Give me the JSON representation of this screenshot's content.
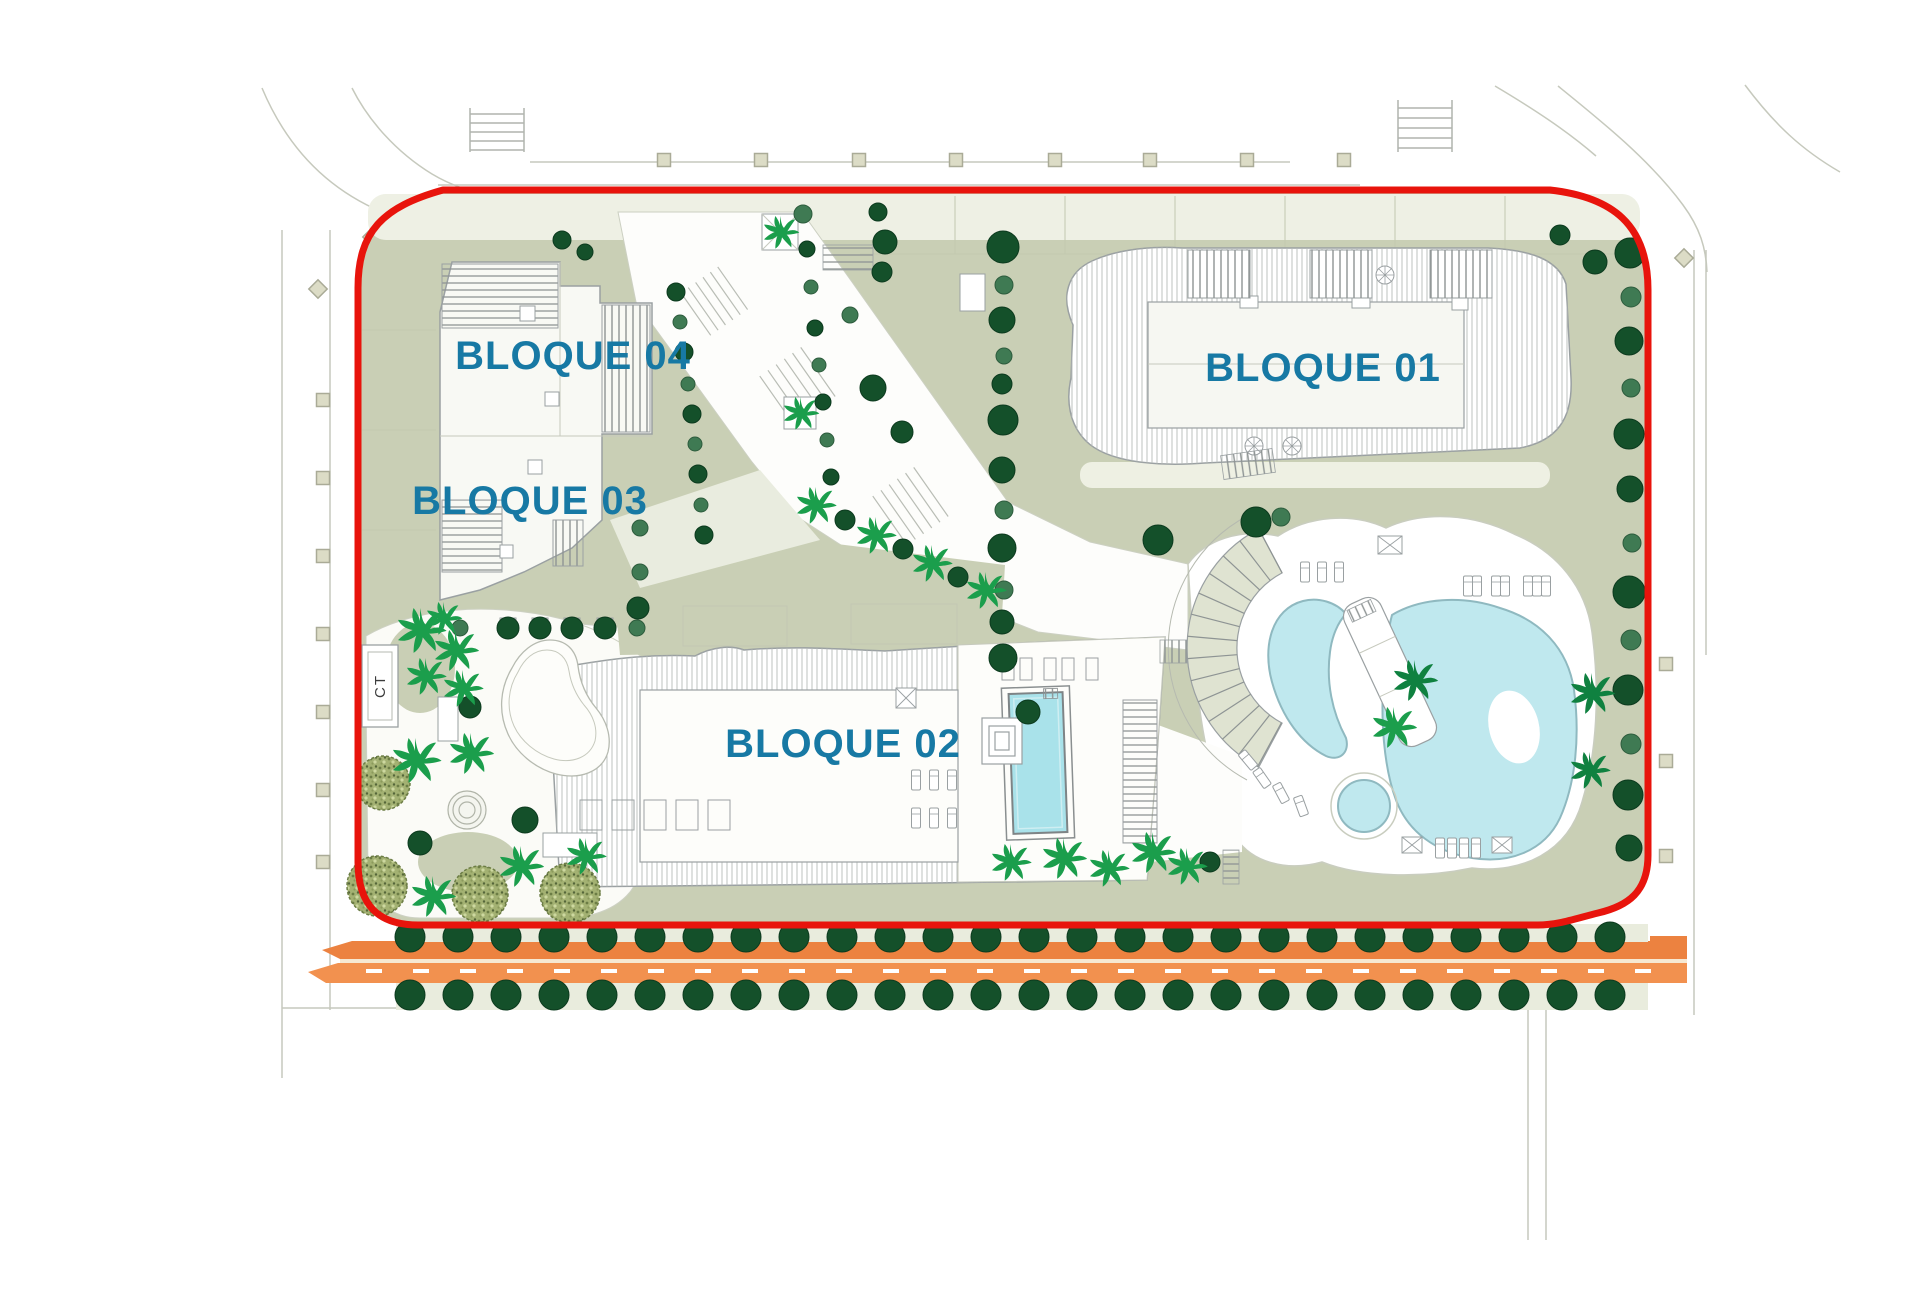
{
  "labels": {
    "bloque01": "BLOQUE 01",
    "bloque02": "BLOQUE 02",
    "bloque03": "BLOQUE 03",
    "bloque04": "BLOQUE 04",
    "ct": "CT"
  },
  "colors": {
    "boundary_red": "#e8140c",
    "sage": "#c9cfb5",
    "pale_sage": "#e9ecdd",
    "deck_sage": "#dfe3d1",
    "garden_white": "#fbfbf7",
    "pool_fill": "#bfe8ee",
    "pool_stroke": "#8fb9c0",
    "lap_pool": "#a9e2ea",
    "orange_top": "#ec8240",
    "orange_main": "#f2914f",
    "orange_gap": "#f6e8d2",
    "tree_dark": "#14502a",
    "tree_medium": "#3f7a53",
    "palm_bright": "#1b9e4c",
    "palm_dark": "#0f8140",
    "label_teal": "#1779a4",
    "line_gray": "#9aa0a2",
    "line_light": "#c6c9bd",
    "beige": "#dcdcc6",
    "mottle_base": "#a3b172"
  },
  "street": {
    "tree_rows": {
      "x_start": 410,
      "spacing": 48,
      "count": 26,
      "y_top": 937,
      "y_bottom": 995,
      "radius": 15
    },
    "dashes": {
      "x_start": 366,
      "spacing": 47,
      "count": 28,
      "y": 969,
      "w": 16,
      "h": 4
    },
    "squares_top": {
      "y": 160,
      "x": [
        664,
        761,
        859,
        956,
        1055,
        1150,
        1247,
        1344
      ]
    },
    "squares_left": {
      "x": 323,
      "y": [
        400,
        478,
        556,
        634,
        712,
        790,
        862
      ]
    },
    "squares_right": {
      "x": 1666,
      "y": [
        664,
        761,
        856
      ]
    },
    "diamonds": [
      [
        318,
        289
      ],
      [
        372,
        237
      ],
      [
        1684,
        258
      ]
    ]
  },
  "vegetation": {
    "round_trees": [
      {
        "x": 1630,
        "y": 253,
        "r": 15,
        "s": "d"
      },
      {
        "x": 1631,
        "y": 297,
        "r": 10,
        "s": "m"
      },
      {
        "x": 1629,
        "y": 341,
        "r": 14,
        "s": "d"
      },
      {
        "x": 1631,
        "y": 388,
        "r": 9,
        "s": "m"
      },
      {
        "x": 1629,
        "y": 434,
        "r": 15,
        "s": "d"
      },
      {
        "x": 1630,
        "y": 489,
        "r": 13,
        "s": "d"
      },
      {
        "x": 1632,
        "y": 543,
        "r": 9,
        "s": "m"
      },
      {
        "x": 1629,
        "y": 592,
        "r": 16,
        "s": "d"
      },
      {
        "x": 1631,
        "y": 640,
        "r": 10,
        "s": "m"
      },
      {
        "x": 1628,
        "y": 690,
        "r": 15,
        "s": "d"
      },
      {
        "x": 1631,
        "y": 744,
        "r": 10,
        "s": "m"
      },
      {
        "x": 1628,
        "y": 795,
        "r": 15,
        "s": "d"
      },
      {
        "x": 1629,
        "y": 848,
        "r": 13,
        "s": "d"
      },
      {
        "x": 1560,
        "y": 235,
        "r": 10,
        "s": "d"
      },
      {
        "x": 1595,
        "y": 262,
        "r": 12,
        "s": "d"
      },
      {
        "x": 1003,
        "y": 247,
        "r": 16,
        "s": "d"
      },
      {
        "x": 1004,
        "y": 285,
        "r": 9,
        "s": "m"
      },
      {
        "x": 1002,
        "y": 320,
        "r": 13,
        "s": "d"
      },
      {
        "x": 1004,
        "y": 356,
        "r": 8,
        "s": "m"
      },
      {
        "x": 1002,
        "y": 384,
        "r": 10,
        "s": "d"
      },
      {
        "x": 1003,
        "y": 420,
        "r": 15,
        "s": "d"
      },
      {
        "x": 1002,
        "y": 470,
        "r": 13,
        "s": "d"
      },
      {
        "x": 1004,
        "y": 510,
        "r": 9,
        "s": "m"
      },
      {
        "x": 1002,
        "y": 548,
        "r": 14,
        "s": "d"
      },
      {
        "x": 1004,
        "y": 590,
        "r": 9,
        "s": "m"
      },
      {
        "x": 1002,
        "y": 622,
        "r": 12,
        "s": "d"
      },
      {
        "x": 1003,
        "y": 658,
        "r": 14,
        "s": "d"
      },
      {
        "x": 676,
        "y": 292,
        "r": 9,
        "s": "d"
      },
      {
        "x": 680,
        "y": 322,
        "r": 7,
        "s": "m"
      },
      {
        "x": 684,
        "y": 352,
        "r": 9,
        "s": "d"
      },
      {
        "x": 688,
        "y": 384,
        "r": 7,
        "s": "m"
      },
      {
        "x": 692,
        "y": 414,
        "r": 9,
        "s": "d"
      },
      {
        "x": 695,
        "y": 444,
        "r": 7,
        "s": "m"
      },
      {
        "x": 698,
        "y": 474,
        "r": 9,
        "s": "d"
      },
      {
        "x": 701,
        "y": 505,
        "r": 7,
        "s": "m"
      },
      {
        "x": 704,
        "y": 535,
        "r": 9,
        "s": "d"
      },
      {
        "x": 803,
        "y": 214,
        "r": 9,
        "s": "m"
      },
      {
        "x": 807,
        "y": 249,
        "r": 8,
        "s": "d"
      },
      {
        "x": 811,
        "y": 287,
        "r": 7,
        "s": "m"
      },
      {
        "x": 815,
        "y": 328,
        "r": 8,
        "s": "d"
      },
      {
        "x": 819,
        "y": 365,
        "r": 7,
        "s": "m"
      },
      {
        "x": 823,
        "y": 402,
        "r": 8,
        "s": "d"
      },
      {
        "x": 827,
        "y": 440,
        "r": 7,
        "s": "m"
      },
      {
        "x": 831,
        "y": 477,
        "r": 8,
        "s": "d"
      },
      {
        "x": 878,
        "y": 212,
        "r": 9,
        "s": "d"
      },
      {
        "x": 885,
        "y": 242,
        "r": 12,
        "s": "d"
      },
      {
        "x": 882,
        "y": 272,
        "r": 10,
        "s": "d"
      },
      {
        "x": 850,
        "y": 315,
        "r": 8,
        "s": "m"
      },
      {
        "x": 562,
        "y": 240,
        "r": 9,
        "s": "d"
      },
      {
        "x": 585,
        "y": 252,
        "r": 8,
        "s": "d"
      },
      {
        "x": 508,
        "y": 628,
        "r": 11,
        "s": "d"
      },
      {
        "x": 540,
        "y": 628,
        "r": 11,
        "s": "d"
      },
      {
        "x": 572,
        "y": 628,
        "r": 11,
        "s": "d"
      },
      {
        "x": 605,
        "y": 628,
        "r": 11,
        "s": "d"
      },
      {
        "x": 460,
        "y": 628,
        "r": 8,
        "s": "m"
      },
      {
        "x": 637,
        "y": 628,
        "r": 8,
        "s": "m"
      },
      {
        "x": 640,
        "y": 528,
        "r": 8,
        "s": "m"
      },
      {
        "x": 640,
        "y": 572,
        "r": 8,
        "s": "m"
      },
      {
        "x": 638,
        "y": 608,
        "r": 11,
        "s": "d"
      },
      {
        "x": 845,
        "y": 520,
        "r": 10,
        "s": "d"
      },
      {
        "x": 903,
        "y": 549,
        "r": 10,
        "s": "d"
      },
      {
        "x": 958,
        "y": 577,
        "r": 10,
        "s": "d"
      },
      {
        "x": 1158,
        "y": 540,
        "r": 15,
        "s": "d"
      },
      {
        "x": 1256,
        "y": 522,
        "r": 15,
        "s": "d"
      },
      {
        "x": 1281,
        "y": 517,
        "r": 9,
        "s": "m"
      },
      {
        "x": 1028,
        "y": 712,
        "r": 12,
        "s": "d"
      },
      {
        "x": 470,
        "y": 707,
        "r": 11,
        "s": "d"
      },
      {
        "x": 420,
        "y": 843,
        "r": 12,
        "s": "d"
      },
      {
        "x": 525,
        "y": 820,
        "r": 13,
        "s": "d"
      },
      {
        "x": 873,
        "y": 388,
        "r": 13,
        "s": "d"
      },
      {
        "x": 902,
        "y": 432,
        "r": 11,
        "s": "d"
      },
      {
        "x": 1210,
        "y": 862,
        "r": 10,
        "s": "d"
      }
    ],
    "palms": [
      {
        "x": 415,
        "y": 760,
        "s": 22,
        "c": "b"
      },
      {
        "x": 470,
        "y": 753,
        "s": 20,
        "c": "b"
      },
      {
        "x": 432,
        "y": 896,
        "s": 20,
        "c": "b"
      },
      {
        "x": 520,
        "y": 866,
        "s": 20,
        "c": "b"
      },
      {
        "x": 585,
        "y": 856,
        "s": 18,
        "c": "b"
      },
      {
        "x": 420,
        "y": 630,
        "s": 22,
        "c": "b"
      },
      {
        "x": 455,
        "y": 650,
        "s": 20,
        "c": "b"
      },
      {
        "x": 425,
        "y": 676,
        "s": 18,
        "c": "b"
      },
      {
        "x": 462,
        "y": 688,
        "s": 18,
        "c": "b"
      },
      {
        "x": 443,
        "y": 618,
        "s": 16,
        "c": "b"
      },
      {
        "x": 815,
        "y": 505,
        "s": 18,
        "c": "b"
      },
      {
        "x": 875,
        "y": 535,
        "s": 18,
        "c": "b"
      },
      {
        "x": 931,
        "y": 563,
        "s": 18,
        "c": "b"
      },
      {
        "x": 985,
        "y": 590,
        "s": 18,
        "c": "b"
      },
      {
        "x": 780,
        "y": 232,
        "s": 16,
        "c": "b"
      },
      {
        "x": 800,
        "y": 413,
        "s": 16,
        "c": "b"
      },
      {
        "x": 1010,
        "y": 862,
        "s": 18,
        "c": "b"
      },
      {
        "x": 1063,
        "y": 858,
        "s": 20,
        "c": "b"
      },
      {
        "x": 1108,
        "y": 868,
        "s": 18,
        "c": "b"
      },
      {
        "x": 1152,
        "y": 852,
        "s": 20,
        "c": "b"
      },
      {
        "x": 1186,
        "y": 866,
        "s": 18,
        "c": "b"
      },
      {
        "x": 1414,
        "y": 680,
        "s": 20,
        "c": "d"
      },
      {
        "x": 1393,
        "y": 727,
        "s": 20,
        "c": "b"
      },
      {
        "x": 1591,
        "y": 693,
        "s": 20,
        "c": "d"
      },
      {
        "x": 1589,
        "y": 770,
        "s": 18,
        "c": "d"
      }
    ],
    "mottled_trees": [
      {
        "x": 383,
        "y": 783,
        "r": 27
      },
      {
        "x": 377,
        "y": 886,
        "r": 30
      },
      {
        "x": 480,
        "y": 894,
        "r": 28
      },
      {
        "x": 570,
        "y": 893,
        "r": 30
      }
    ]
  },
  "furniture": {
    "loungers": [
      [
        1305,
        572,
        0
      ],
      [
        1322,
        572,
        0
      ],
      [
        1339,
        572,
        0
      ],
      [
        1468,
        586,
        0
      ],
      [
        1477,
        586,
        0
      ],
      [
        1496,
        586,
        0
      ],
      [
        1505,
        586,
        0
      ],
      [
        1528,
        586,
        0
      ],
      [
        1537,
        586,
        0
      ],
      [
        1546,
        586,
        0
      ],
      [
        1248,
        760,
        -40
      ],
      [
        1262,
        778,
        -35
      ],
      [
        1281,
        793,
        -28
      ],
      [
        1301,
        806,
        -20
      ],
      [
        1440,
        848,
        0
      ],
      [
        1452,
        848,
        0
      ],
      [
        1464,
        848,
        0
      ],
      [
        1476,
        848,
        0
      ],
      [
        916,
        780,
        0
      ],
      [
        934,
        780,
        0
      ],
      [
        952,
        780,
        0
      ],
      [
        916,
        818,
        0
      ],
      [
        934,
        818,
        0
      ],
      [
        952,
        818,
        0
      ]
    ],
    "xboxes": [
      [
        1390,
        545,
        24,
        18
      ],
      [
        1412,
        845,
        20,
        16
      ],
      [
        1502,
        845,
        20,
        16
      ],
      [
        906,
        698,
        20,
        20
      ]
    ]
  }
}
